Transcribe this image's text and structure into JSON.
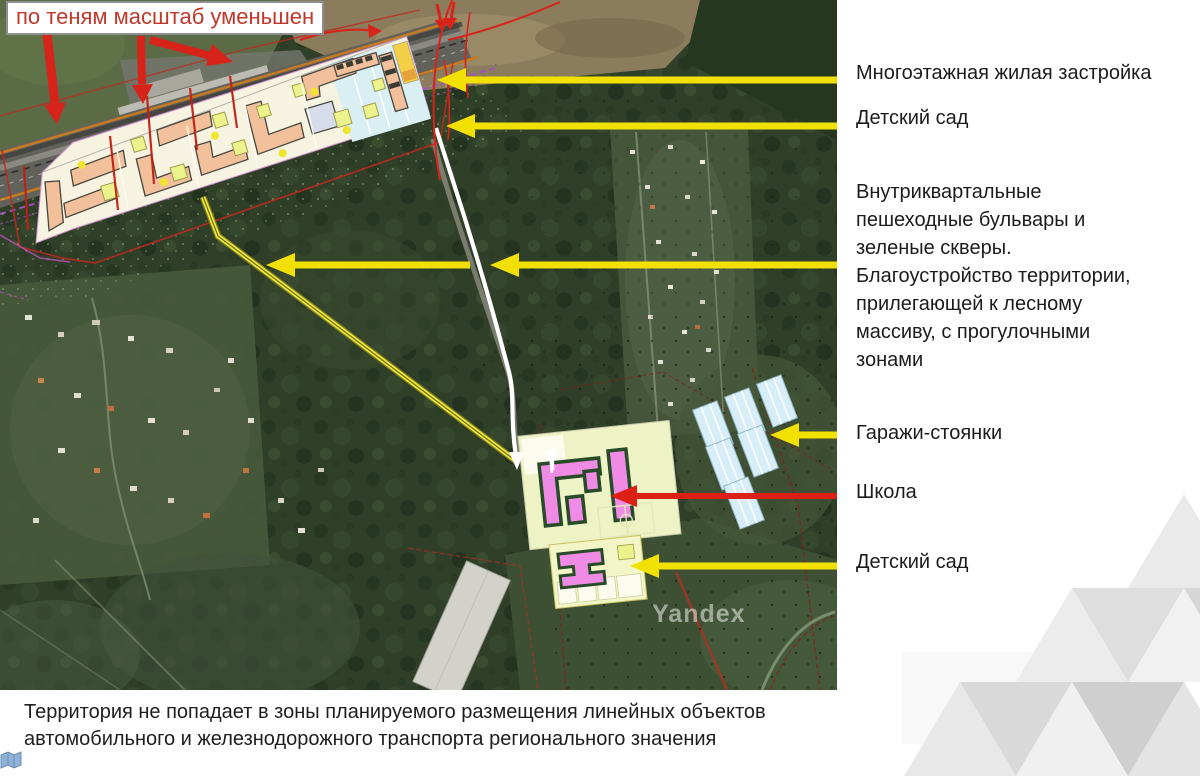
{
  "map": {
    "note": "по теням масштаб уменьшен",
    "watermark": "Yandex"
  },
  "labels": {
    "residential": "Многоэтажная жилая застройка",
    "kindergarten_top": "Детский сад",
    "boulevards": "Внутриквартальные\nпешеходные бульвары и\nзеленые скверы.\nБлагоустройство территории,\nприлегающей к лесному\nмассиву, с прогулочными\nзонами",
    "garages": "Гаражи-стоянки",
    "school": "Школа",
    "kindergarten_bottom": "Детский сад"
  },
  "footer": {
    "text": "Территория не попадает в зоны планируемого размещения линейных объектов\nавтомобильного и железнодорожного транспорта регионального значения"
  },
  "colors": {
    "annotation_yellow": "#f2e000",
    "annotation_red": "#d8231a",
    "note_text_red": "#bf382a",
    "masterplan_cream": "#f6f3e1",
    "building_salmon": "#f3c09c",
    "school_pink": "#ef8be4",
    "plot_yellow_green": "#eef3c6",
    "garage_light_blue": "#d7edf8",
    "forest_green_dark": "#2f3f28"
  }
}
